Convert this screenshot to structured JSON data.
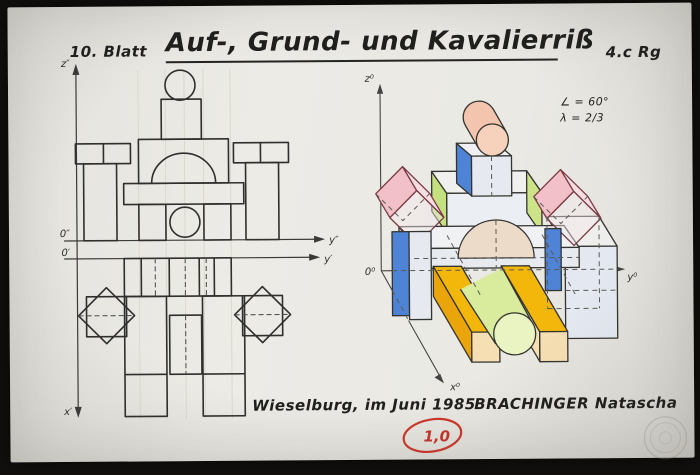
{
  "header": {
    "sheet_number": "10. Blatt",
    "title": "Auf-, Grund- und Kavalierriß",
    "class_tag": "4.c Rg"
  },
  "cavalier_view": {
    "annotation_angle": "∠ = 60°",
    "annotation_lambda": "λ = 2/3",
    "axis_z": "z⁰",
    "axis_y": "y⁰",
    "axis_x": "x⁰",
    "origin": "0⁰"
  },
  "ortho_view": {
    "axis_z": "z″",
    "axis_y_front": "y″",
    "axis_y_plan": "y′",
    "axis_x": "x′",
    "origin_front": "0″",
    "origin_plan": "0′"
  },
  "footer": {
    "place_date": "Wieselburg, im Juni 1985",
    "author": "BRACHINGER Natascha",
    "grade": "1,0"
  },
  "palette": {
    "paper": "#e9e8e3",
    "ink": "#2e2e2c",
    "red_pen": "#c93a2e",
    "blue": "#4f83d6",
    "light_blue": "#e4e9f1",
    "green": "#c5e07e",
    "light_green": "#d9ec9e",
    "yellow": "#f3b70c",
    "tan": "#f6dfb2",
    "salmon": "#f3c5ae",
    "pink": "#f2c0c9",
    "arch_tan": "#ecdbc8"
  },
  "icons": {
    "seal": "embossed-circular-seal"
  }
}
